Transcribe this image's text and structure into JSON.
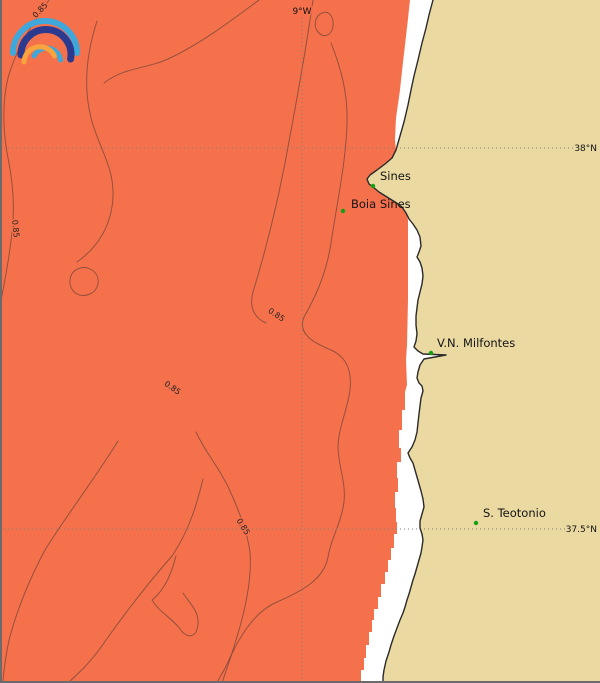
{
  "map_title": "Coastal field map - Sines region",
  "palette": {
    "sea": "#f5714c",
    "land": "#ebd9a2",
    "shore_gap": "#ffffff",
    "coastline": "#2a2a2a",
    "contour": "#7c4838",
    "grid": "#7f7f7f",
    "marker": "#12a015",
    "frame": "#6b6b6b",
    "label_text": "#141414"
  },
  "logo": {
    "name": "rainbow-arcs-logo",
    "arc_outer": "#3ea8dc",
    "arc_second": "#2b3a8f",
    "arc_third": "#3ea8dc",
    "arc_inner": "#f9a43c"
  },
  "grid": {
    "meridian": {
      "label": "9°W"
    },
    "parallel_north": {
      "label": "38°N"
    },
    "parallel_south": {
      "label": "37.5°N"
    }
  },
  "contour_value": "0.85",
  "places": [
    {
      "name": "Sines"
    },
    {
      "name": "Boia Sines"
    },
    {
      "name": "V.N. Milfontes"
    },
    {
      "name": "S. Teotonio"
    }
  ]
}
